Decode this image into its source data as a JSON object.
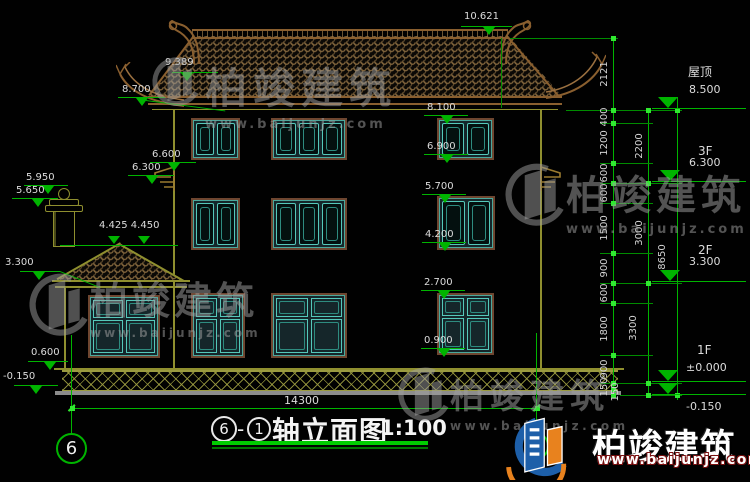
{
  "drawing": {
    "title": {
      "axis_left": "6",
      "separator": "-",
      "axis_right": "1",
      "name": "轴立面图",
      "scale": "1:100"
    },
    "axis_bubbles": {
      "left": "6",
      "right": "1"
    },
    "overall_width_mm": "14300",
    "overall_height_mm": "8650",
    "ridge_level": "10.621",
    "left_levels": {
      "l9389": "9.389",
      "l8700": "8.700",
      "l6600": "6.600",
      "l6300": "6.300",
      "l5950": "5.950",
      "l5650": "5.650",
      "l4425": "4.425 4.450",
      "l3300": "3.300",
      "l0600": "0.600",
      "lm0150": "-0.150"
    },
    "mid_levels": {
      "l8100": "8.100",
      "l6900": "6.900",
      "l5700": "5.700",
      "l4200": "4.200",
      "l2700": "2.700",
      "l0900": "0.900"
    },
    "floor_levels": [
      {
        "floor": "屋顶",
        "value": "8.500"
      },
      {
        "floor": "3F",
        "value": "6.300"
      },
      {
        "floor": "2F",
        "value": "3.300"
      },
      {
        "floor": "1F",
        "value": "±0.000"
      },
      {
        "floor": "",
        "value": "-0.150"
      }
    ],
    "chain_a": [
      "2121",
      "400",
      "1200",
      "600",
      "600",
      "1500",
      "900",
      "600",
      "1800",
      "900",
      "150",
      "150"
    ],
    "chain_b": [
      "2200",
      "3000",
      "3300"
    ]
  },
  "watermark": {
    "brand": "柏竣建筑",
    "site": "www.baijunjz.com"
  },
  "logo": {
    "brand": "柏竣建筑",
    "site": "www.baijunjz.com"
  },
  "colors": {
    "dim_green": "#00b400",
    "bright_green": "#30e830",
    "text_white": "#dcdcdc",
    "wall_olive": "#8f8f2f",
    "roof_brown": "#8a5f2f",
    "window_teal": "#55c8ba",
    "frame_brown": "#6e4630",
    "logo_blue": "#1d5fa9",
    "logo_orange": "#e8821e",
    "watermark_gray": "#9e9e9e"
  }
}
